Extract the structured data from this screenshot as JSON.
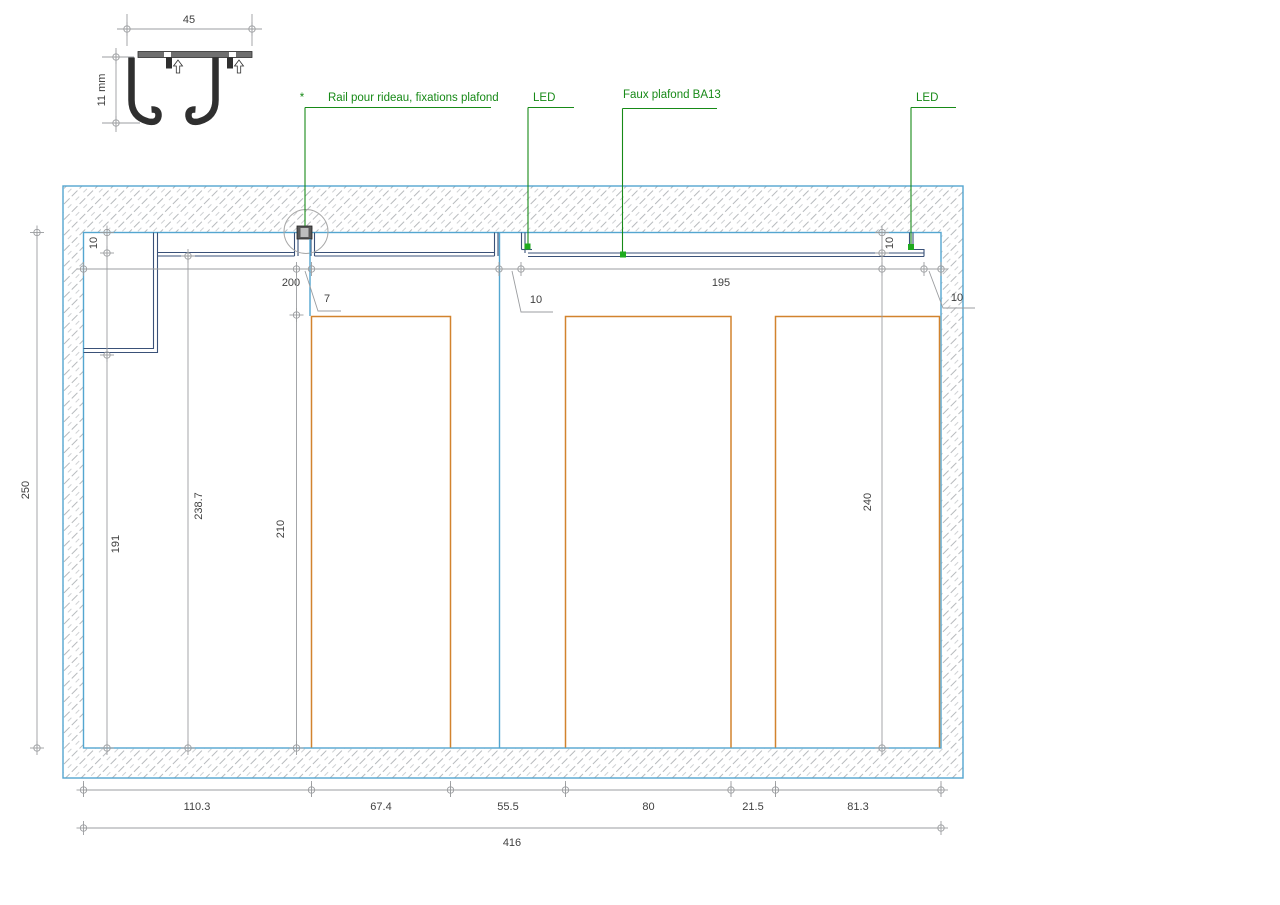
{
  "drawing_title": "Ceiling section detail — curtain rail, LED coves, false ceiling",
  "detail": {
    "width": "45",
    "height": "11 mm"
  },
  "callouts": {
    "bullet": "*",
    "rail": "Rail pour rideau, fixations plafond",
    "led_left": "LED",
    "faux_plafond": "Faux plafond BA13",
    "led_right": "LED"
  },
  "dims": {
    "drop_left": "10",
    "offset": "200",
    "rail_gap": "7",
    "cove_gap_mid": "10",
    "ceiling_span": "195",
    "drop_right": "10",
    "cove_gap_right": "10",
    "room_height": "250",
    "h_bulkhead": "191",
    "h_ceiling_left": "238.7",
    "h_opening": "210",
    "h_ceiling_right": "240",
    "w_1": "110.3",
    "w_2": "67.4",
    "w_3": "55.5",
    "w_4": "80",
    "w_5": "21.5",
    "w_6": "81.3",
    "w_total": "416"
  },
  "colors": {
    "wall_outline": "#54a6d0",
    "structure": "#3a5178",
    "furniture": "#d2832e",
    "annotation": "#178a17",
    "led_dot": "#1eaa1e",
    "dimension": "#9b9da0",
    "hatch": "#b7babd"
  }
}
